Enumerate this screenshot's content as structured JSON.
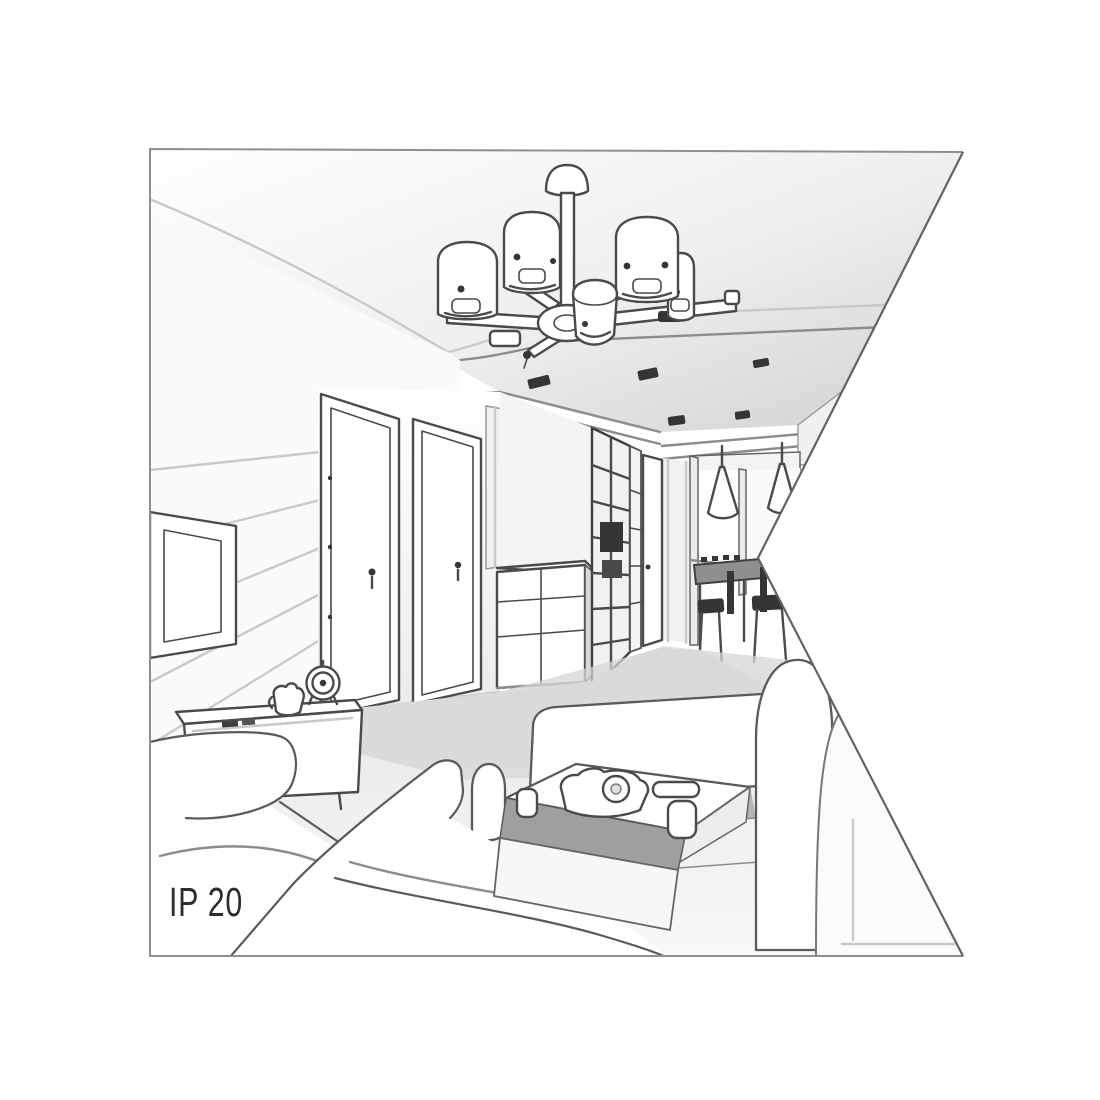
{
  "illustration": {
    "description": "Perspective grayscale line drawing of a living room interior showing a multi-arm ceiling chandelier, two interior doors, TV wall, wardrobe, dining nook with pendant lamps and sofas around a coffee table; drawing panel has a triangular notch cut from its right edge",
    "ip_rating_label": "IP 20",
    "colors": {
      "background": "#ffffff",
      "ink": "#4a4a4a",
      "ink_dark": "#353535",
      "frame_border": "#8a8a8a",
      "notch_edge": "#636363",
      "ceiling_shade": "#d9d9d9",
      "floor_shade": "#d6d6d6",
      "label_color": "#2d2d2d"
    },
    "scene_objects": [
      "chandelier-five-shades",
      "ceiling-spotlights",
      "tv-wall-panel",
      "interior-door-left",
      "interior-door-right",
      "chest-of-drawers",
      "grid-wardrobe",
      "hallway-door",
      "dining-pendant-lamps",
      "dining-table",
      "bar-stools",
      "tv-stand",
      "alarm-clock",
      "tea-set",
      "armchair",
      "corner-sofa",
      "coffee-table",
      "coffee-table-items"
    ]
  }
}
